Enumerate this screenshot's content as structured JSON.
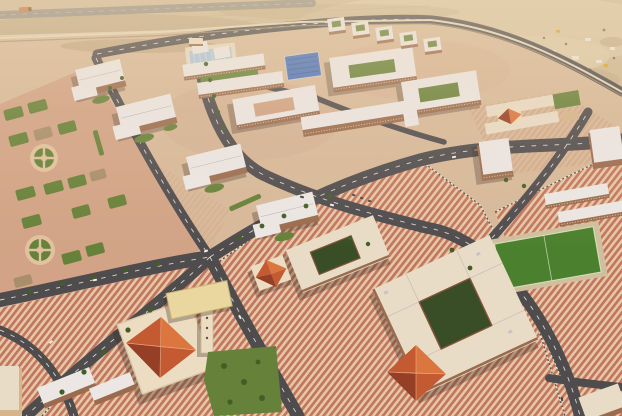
{
  "image": {
    "kind": "aerial-photograph",
    "description": "Aerial oblique view at golden hour of a newly built desert compound: rows of schools and apartment blocks with white roofs, a mosque with red pyramidal roof and minaret, large courtyard buildings with red hip roofs, candy-striped paved plazas, landscaped gardens with circular plazas, a green sports field, a pool and blue-tarped courts, empty dark asphalt roads with dashed lane markings, a perimeter wall and a sandy construction yard beyond",
    "width": 622,
    "height": 416
  },
  "palette": {
    "sand": "#cdb897",
    "sandLight": "#ddccae",
    "sandDark": "#b29a77",
    "asphalt": "#43434a",
    "asphaltLight": "#8e8b84",
    "roadMark": "#f2f0ea",
    "pavingBase": "#d6b99c",
    "pavingPink": "#d0a186",
    "stripePink": "#bf6f5f",
    "stripeCream": "#e5cba7",
    "curbLight": "#ece4d2",
    "curbDark": "#23211f",
    "lawn": "#5c7c33",
    "lawnBright": "#3f7c27",
    "courtyard": "#2c451f",
    "tree": "#36561f",
    "roofWhite": "#eceaec",
    "roofShadow": "#b9b2bd",
    "roofCream": "#e9decb",
    "roofRed": "#c0522c",
    "roofRedLight": "#d97038",
    "roofRedDark": "#8f3520",
    "wallBrown": "#95654a",
    "wallBeige": "#d5b48c",
    "trimBrown": "#7c4c34",
    "cream": "#ecdfc6",
    "canopy": "#ead9a2",
    "poolBlue": "#a9c8e4",
    "tarpBlue": "#3e6dc2",
    "wallLine": "#e5d9bf",
    "wallShadow": "#9d8a6c",
    "carWhite": "#f4f2ee",
    "carDark": "#393e45",
    "truckOrange": "#c8742e"
  }
}
